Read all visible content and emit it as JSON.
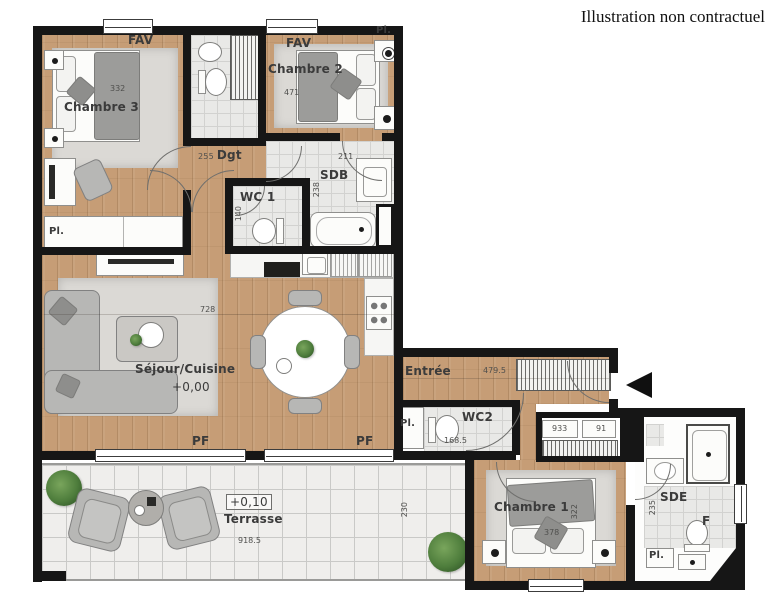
{
  "title": "Illustration non contractuel",
  "colors": {
    "wall": "#161616",
    "wood_floor": "#c69d76",
    "tile_floor": "#e9e9e7",
    "terrace_tile": "#efeeec",
    "furniture_gray": "#b7b7b5",
    "rug_gray": "#dbd9d5",
    "plant_green": "#4e7d3c"
  },
  "rooms": {
    "chambre3": {
      "label": "Chambre 3",
      "dim": "332",
      "window": "FAV",
      "closet": "Pl."
    },
    "chambre2": {
      "label": "Chambre 2",
      "dim": "471",
      "window": "FAV",
      "closet": "Pl."
    },
    "dgt": {
      "label": "Dgt",
      "dim": "255"
    },
    "wc1": {
      "label": "WC 1",
      "dim": "140"
    },
    "sdb": {
      "label": "SDB",
      "dim_w": "211",
      "dim_h": "238"
    },
    "sejour": {
      "label": "Séjour/Cuisine",
      "level": "+0,00",
      "dim": "728",
      "window1": "PF",
      "window2": "PF"
    },
    "entree": {
      "label": "Entrée",
      "dim": "479.5",
      "closet_dim": "933",
      "closet_dim2": "91"
    },
    "wc2": {
      "label": "WC2",
      "dim": "168.5",
      "closet": "Pl."
    },
    "chambre1": {
      "label": "Chambre 1",
      "dim_h": "322",
      "dim_w": "378"
    },
    "sde": {
      "label": "SDE",
      "dim_h": "235",
      "window": "F",
      "closet": "Pl."
    },
    "terrasse": {
      "label": "Terrasse",
      "level": "+0,10",
      "dim_w": "918.5",
      "dim_h": "230"
    }
  }
}
